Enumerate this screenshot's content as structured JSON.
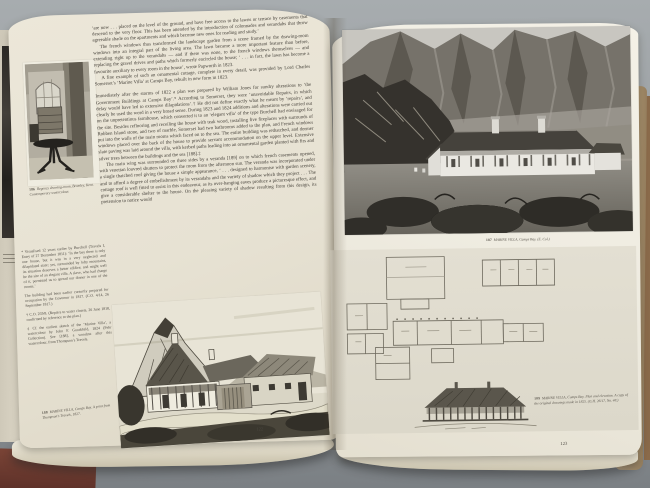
{
  "book": {
    "title_context": "open book spread on grey table",
    "left_page": {
      "page_number": "122",
      "margin_figure": {
        "number": "186",
        "caption": "Regency drawing-room, Bromley, Kent. Contemporary watercolour."
      },
      "body_paragraphs": [
        "‘are now . . . placed on the level of the ground, and have free access to the lawns or terrace by casements that descend to the very floor. This has been attended by the introduction of colonnades and verandahs that throw agreeable shade on the apartments and which become new ones for reading and study.’",
        "The french windows thus transformed the landscape garden from a scene framed by the drawing-room windows into an integral part of the living area. The lawn became a more important feature than before, extending right up to the verandahs — and if there was none, to the french windows themselves — and replacing the gravel drives and paths which formerly encircled the house; ‘ . . . in fact, the lawn has become a favourite auxiliary to every room in the house’, wrote Papworth in 1823.",
        "A fine example of such an ornamental cottage, complete in every detail, was provided by Lord Charles Somerset’s ‘Marine Villa’ at Camps Bay, rebuilt in new form in 1823.",
        "Immediately after the storms of 1822 a plan was prepared by William Jones for sundry alterations to ‘the Government Buildings at Camps Bay’.* According to Somerset, they were ‘unavoidable Repairs, in which delay would have led to extensive dilapidations’.† He did not define exactly what he meant by ‘repairs’, and clearly he used the word in a very broad sense. During 1823 and 1824 additions and alterations were carried out on the unpretentious farmhouse, which converted it to an ‘elegant villa’ of the type Burchell had envisaged for the site. Besides reflooring and receiling the house with teak wood, installing five fireplaces with surrounds of Robben Island stone, and two of marble, Somerset had two bathrooms added to the plan, and French windows put into the walls of the main rooms which faced on to the sea. The entire building was rethatched, and dormer windows placed over the back of the house to provide servant accommodation on the upper level. Extensive slate paving was laid around the villa, with kerbed paths leading into an ornamental garden planted with firs and silver trees between the buildings and the sea [188].‡",
        "The main wing was surrounded on three sides by a veranda [189] on to which french casements opened, with venetian louvred shutters to protect the room from the afternoon sun. The veranda was incorporated under a single thatched roof giving the house a simple appearance, ‘ . . . designed to harmonise with garden scenery, and to afford a degree of embellishment by its verandahs and the variety of shadow which they project . . . The cottage roof is well fitted to assist in this endeavour, as its over-hanging eaves produce a picturesque effect, and give a considerable shelter to the house. On the pleasing variety of shadow resulting from this design, its pretension to notice would"
      ],
      "footnotes": [
        "* Visualised 12 years earlier by Burchell (Travels I, Entry of 27 December 1811): ‘In the bay there is only one house, but it was in a very neglected and dilapidated state; yet, surrounded by lofty mountains, its situation deserves a better edifice; and might well be the site of an elegant villa. A slave, who had charge of it, permitted us to spread our dinner in one of the rooms.’",
        "The building had been earlier cursorily prepared for occupation by the Governor in 1817. (C.O. 4/14, 26 September 1817.)",
        "† C.O. 259/8. (Repairs to water closets, 26 June 1818, confirmed by reference to the plan.)",
        "‡ Cf. the earliest sketch of the ‘Marine Villa’, a watercolour by John F. Goodchild, 1824 (Fehr Collection). See [188], a woodcut after this watercolour, from Thompson’s Travels."
      ],
      "bottom_figure": {
        "number": "188",
        "caption": "MARINE VILLA, Camps Bay. A print from Thompson’s Travels, 1827."
      }
    },
    "right_page": {
      "page_number": "123",
      "photo_figure": {
        "number": "187",
        "caption": "MARINE VILLA, Camps Bay. (E. Col.)"
      },
      "plan_figure": {
        "number": "189",
        "caption": "MARINE VILLA, Camps Bay. Plan and elevation. A copy of the original drawings made in 1825. (G.H. 26/17, No. 48.)"
      }
    }
  },
  "colors": {
    "table_background": "#969b9f",
    "page_cream": "#ece7d9",
    "ink": "#423e37",
    "fore_edge_tan": "#b49b76",
    "cover_maroon": "#6b392e"
  }
}
